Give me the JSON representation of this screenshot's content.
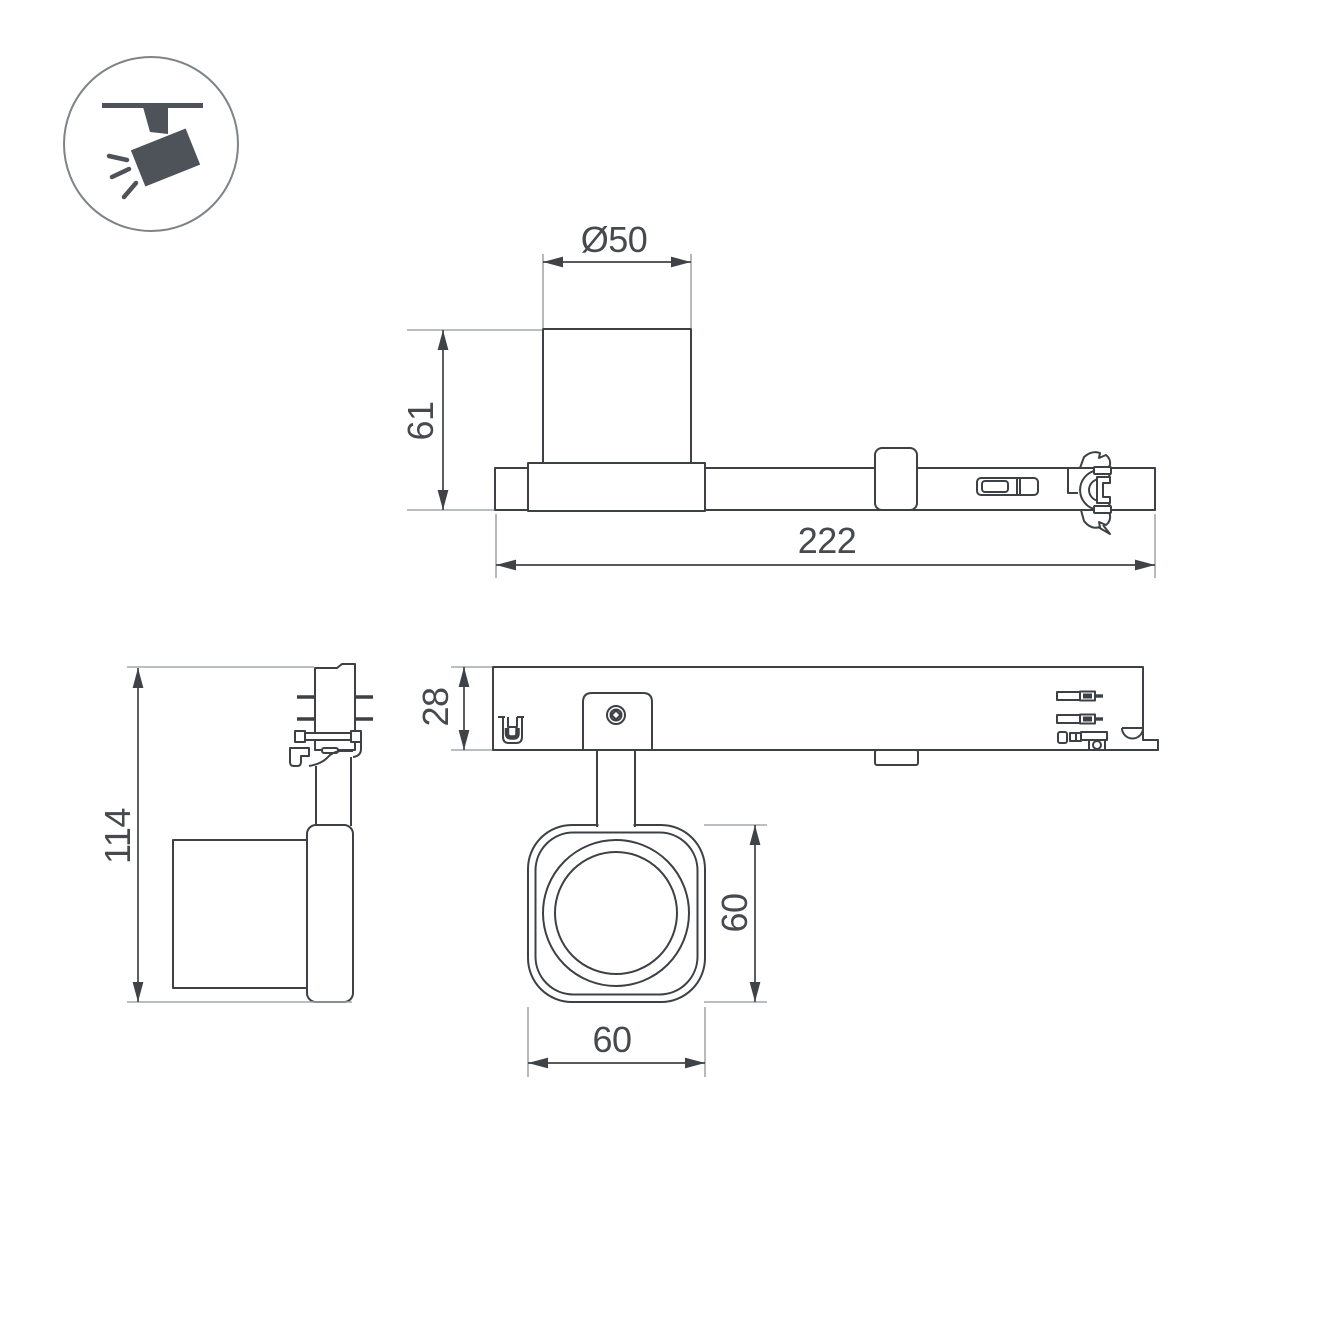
{
  "drawing": {
    "colors": {
      "outline": "#3d4145",
      "dim": "#3f4347",
      "ext": "#a4a8ab",
      "text": "#464a4e",
      "icon_fill": "#4d5358",
      "icon_ring": "#7e8387",
      "bg": "#ffffff"
    },
    "icon": "track-spotlight-icon",
    "views": {
      "side_view": {
        "dim_diameter": "Ø50",
        "dim_height": "61",
        "dim_length": "222"
      },
      "end_view": {
        "dim_height": "114"
      },
      "bottom_view": {
        "dim_track_height": "28",
        "dim_head_height": "60",
        "dim_head_width": "60"
      }
    }
  }
}
